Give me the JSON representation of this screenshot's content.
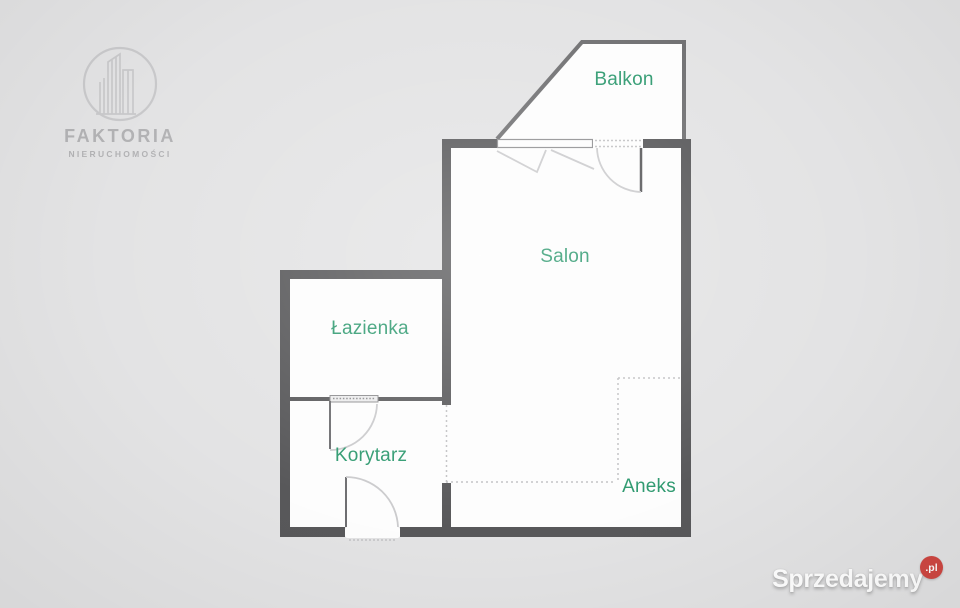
{
  "colors": {
    "background": "#e3e3e4",
    "interior": "#fdfdfd",
    "wall": "#58585a",
    "thin_wall": "#5c5c5e",
    "room_label": "#2f9a70",
    "balcony_outline": "#707072",
    "door_leaf": "#6e6e71",
    "door_arc": "#cbcbcd",
    "window_frame": "#8f8f91",
    "opening_fill": "#ececed",
    "dotted_line": "#c2c2c4",
    "logo_gray": "#b2b2b4",
    "logo_line": "#c9c9cb",
    "watermark_red": "#cf4742",
    "watermark_white": "#ffffff"
  },
  "logo": {
    "title": "FAKTORIA",
    "subtitle": "NIERUCHOMOŚCI",
    "emblem": "buildings-in-circle-icon"
  },
  "floorplan": {
    "type": "apartment-floor-plan",
    "rooms": [
      {
        "id": "balkon",
        "label": "Balkon"
      },
      {
        "id": "salon",
        "label": "Salon"
      },
      {
        "id": "lazienka",
        "label": "Łazienka"
      },
      {
        "id": "korytarz",
        "label": "Korytarz"
      },
      {
        "id": "aneks",
        "label": "Aneks"
      }
    ]
  },
  "watermark": {
    "brand": "Sprzedajemy",
    "suffix": ".pl"
  }
}
